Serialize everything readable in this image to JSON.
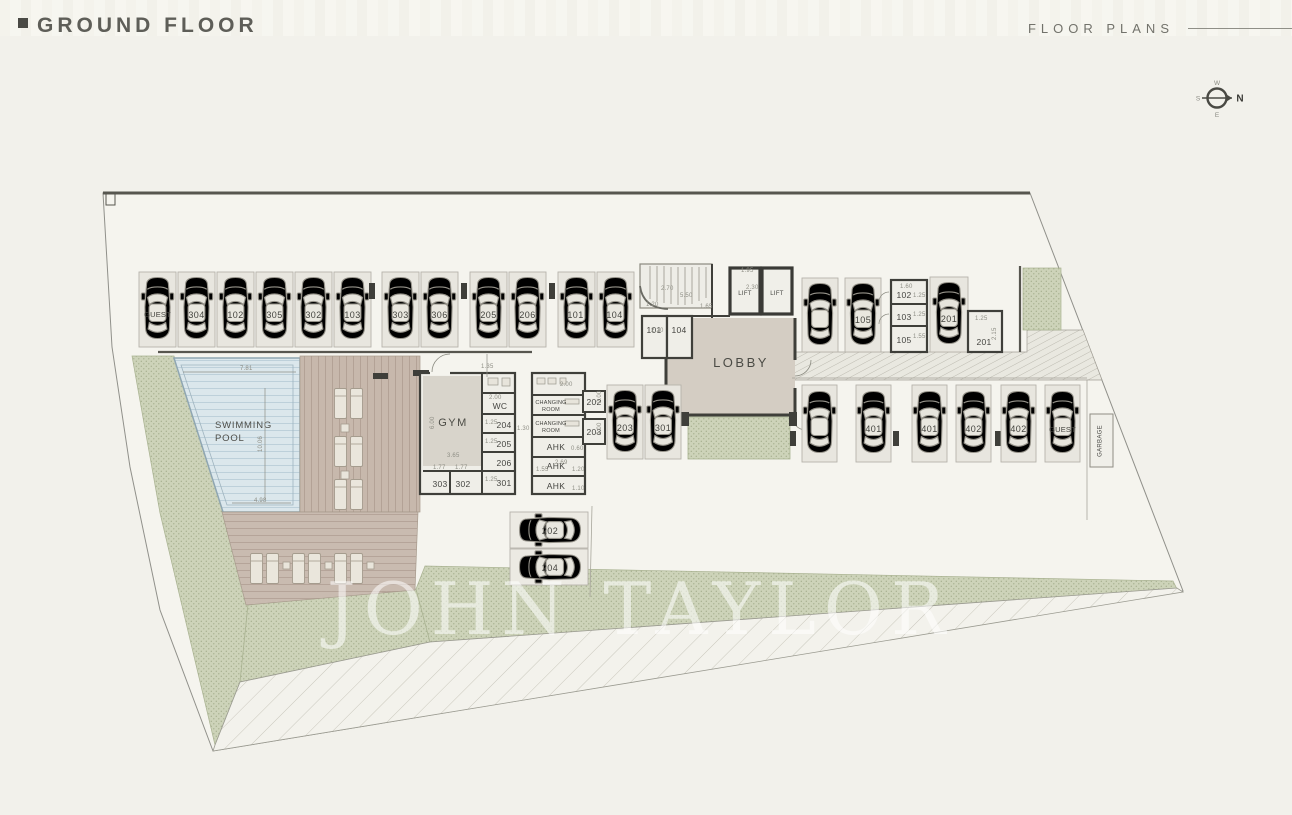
{
  "header": {
    "title": "GROUND FLOOR",
    "right": "FLOOR PLANS"
  },
  "compass": {
    "n": "N",
    "w": "W",
    "s": "S",
    "e": "E"
  },
  "watermark": "JOHN TAYLOR",
  "colors": {
    "background": "#f2f1eb",
    "green": "#cdd3b9",
    "water": "#dbe7ec",
    "deck": "#c7b8ac",
    "wall": "#3f3f3a",
    "lobby_floor": "#d4cdc3"
  },
  "labels": {
    "lobby": "LOBBY",
    "gym": "GYM",
    "wc": "WC",
    "lift": "LIFT",
    "garbage": "GARBAGE",
    "pool1": "SWIMMING",
    "pool2": "POOL",
    "ch1": "CHANGING",
    "ch2": "ROOM",
    "ahk": "AHK"
  },
  "parking": {
    "top_row": [
      "GUEST",
      "304",
      "102",
      "305",
      "302",
      "103",
      "303",
      "306",
      "205",
      "206",
      "101",
      "104"
    ],
    "right_car": [
      "105",
      "201"
    ],
    "mid_cars": [
      "203",
      "301"
    ],
    "right_row": [
      "401",
      "401",
      "402",
      "402",
      "GUEST"
    ],
    "horiz": [
      "202",
      "204"
    ]
  },
  "storage": {
    "lobby": [
      "101",
      "104"
    ],
    "right": [
      "102",
      "103",
      "105"
    ],
    "right_single": "201",
    "gym_col": [
      "204",
      "205",
      "206",
      "301"
    ],
    "gym_bottom": [
      "303",
      "302"
    ],
    "mid": [
      "202",
      "203"
    ]
  },
  "dims": [
    "7.81",
    "10.06",
    "4.98",
    "6.00",
    "3.65",
    "1.77",
    "1.77",
    "1.35",
    "2.00",
    "1.25",
    "1.30",
    "5.50",
    "2.70",
    "1.20",
    "1.65",
    "2.20",
    "1.95",
    "2.30",
    "1.60",
    "1.25",
    "1.55",
    "2.15",
    "1.25",
    "2.00",
    "0.60",
    "2.69",
    "1.55",
    "1.20",
    "1.10",
    "1.25",
    "2.00",
    "2.00",
    "1.25",
    "1.25"
  ]
}
